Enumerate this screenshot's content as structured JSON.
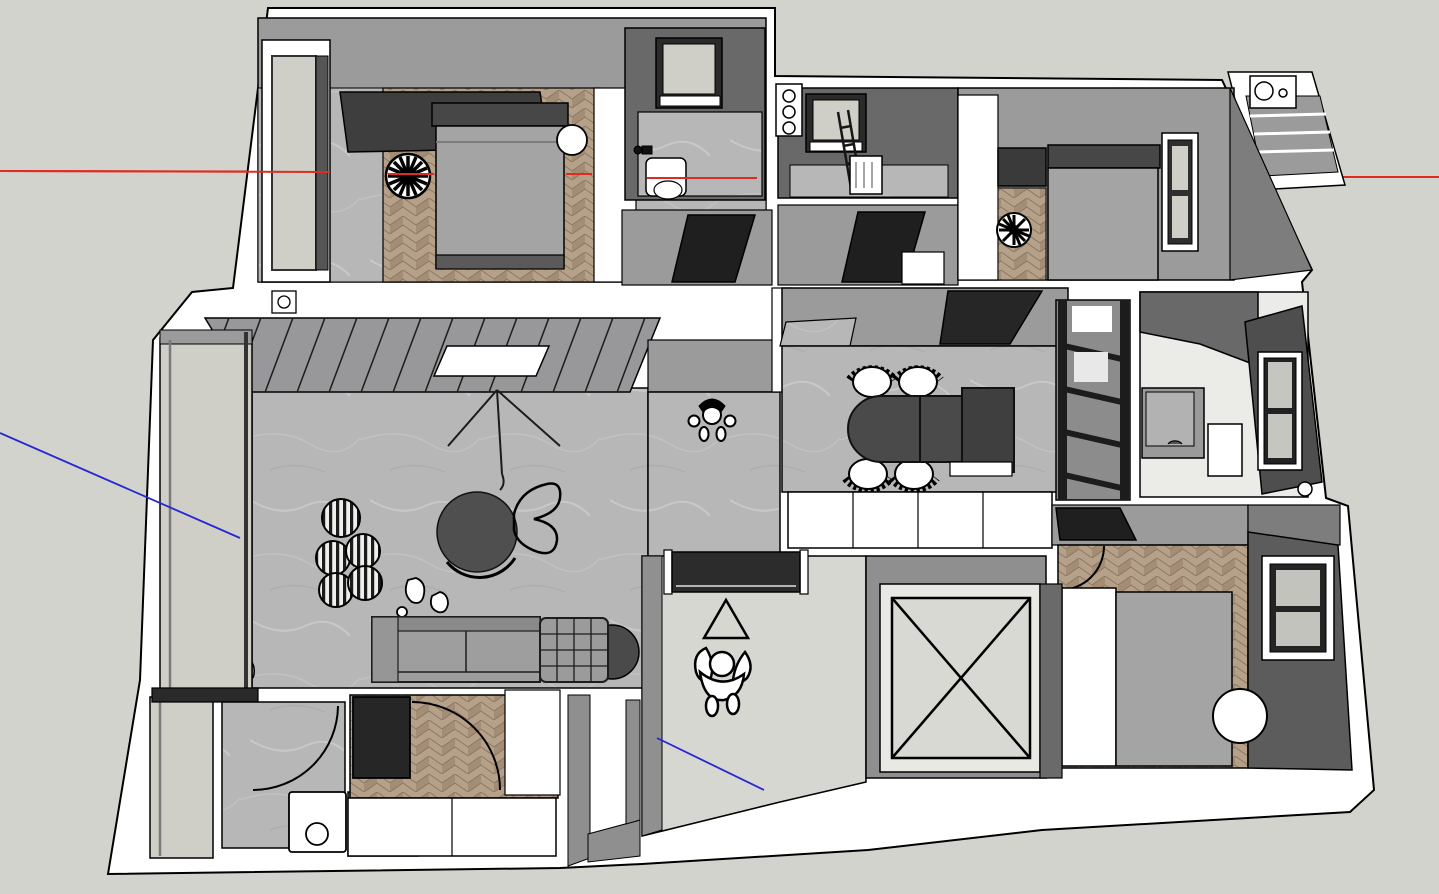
{
  "viewport": {
    "kind": "3d-modeling-viewport",
    "view": "overhead-orbit",
    "model": "furnished-apartment-floor-plan"
  },
  "axes": {
    "red_axis": {
      "color": "#df2c22",
      "orientation": "horizontal"
    },
    "blue_axis": {
      "color": "#2626d4",
      "orientation": "diagonal"
    }
  },
  "colors": {
    "bg": "#d3d3cd",
    "wall_white": "#ffffff",
    "wall_gray": "#9b9b9b",
    "wall_gray_dark": "#7d7d7d",
    "wall_dark": "#5f5f5f",
    "bath_dark": "#696969",
    "floor_marble": "#b7b7b7",
    "floor_light": "#d7d7d1",
    "floor_white": "#ebebe8",
    "wood1": "#b5a089",
    "wood2": "#a38d75",
    "glass": "#cfcfc8",
    "furn_gray": "#a4a4a4",
    "furn_mid": "#8f8f8f",
    "furn_dark": "#474747",
    "furn_black": "#262626",
    "outline": "#000000"
  },
  "rooms": [
    {
      "id": "master-bedroom",
      "floor": "herringbone-wood + gray",
      "furniture": [
        "wardrobe",
        "double-bed",
        "round-nightstand",
        "ceiling-fan",
        "balcony-window"
      ]
    },
    {
      "id": "bathroom-top",
      "floor": "marble",
      "furniture": [
        "window",
        "toilet",
        "wall-faucet"
      ]
    },
    {
      "id": "laundry-bathroom",
      "floor": "marble",
      "furniture": [
        "window",
        "drying-ladder",
        "basket",
        "fixture-panel"
      ]
    },
    {
      "id": "bedroom-2",
      "floor": "herringbone-wood + gray",
      "furniture": [
        "closet",
        "bed",
        "ceiling-fan",
        "window",
        "ac-ledge"
      ]
    },
    {
      "id": "living-room",
      "floor": "marble",
      "furniture": [
        "louvered-ceiling",
        "skylight",
        "floor-lamp",
        "round-coffee-table",
        "lounge-chair",
        "striped-poufs",
        "sofa-with-chaise",
        "side-table",
        "balcony-sliding-door"
      ]
    },
    {
      "id": "hallway",
      "floor": "marble",
      "furniture": [
        "standing-person"
      ]
    },
    {
      "id": "dining-room",
      "floor": "marble",
      "furniture": [
        "oval-dining-table",
        "four-chairs",
        "buffet-cabinet",
        "white-sideboard-row",
        "ladder-shelf",
        "door-panel"
      ]
    },
    {
      "id": "bathroom-right",
      "floor": "white-tile",
      "furniture": [
        "shower-slab",
        "vanity-sink",
        "mirror-panel",
        "window",
        "floor-drain"
      ]
    },
    {
      "id": "bedroom-3",
      "floor": "herringbone-wood",
      "furniture": [
        "desk",
        "door-arc",
        "wardrobe",
        "bed",
        "window",
        "white-ball-pouf"
      ]
    },
    {
      "id": "entry-lobby",
      "floor": "light-tile",
      "furniture": [
        "entry-door",
        "direction-triangle",
        "standing-person"
      ]
    },
    {
      "id": "elevator-shaft",
      "floor": "cross-marked",
      "furniture": [
        "x-brace"
      ]
    },
    {
      "id": "kitchen-balcony",
      "floor": "marble",
      "furniture": [
        "sliding-glass",
        "door-arc",
        "washing-machine",
        "counter"
      ]
    },
    {
      "id": "study",
      "floor": "herringbone-wood",
      "furniture": [
        "black-desk",
        "door-arc",
        "closet",
        "platform-cabinets"
      ]
    }
  ],
  "figures": [
    {
      "id": "person-hallway",
      "pose": "standing-top-view"
    },
    {
      "id": "person-entry",
      "pose": "standing-arms-out-top-view"
    }
  ]
}
